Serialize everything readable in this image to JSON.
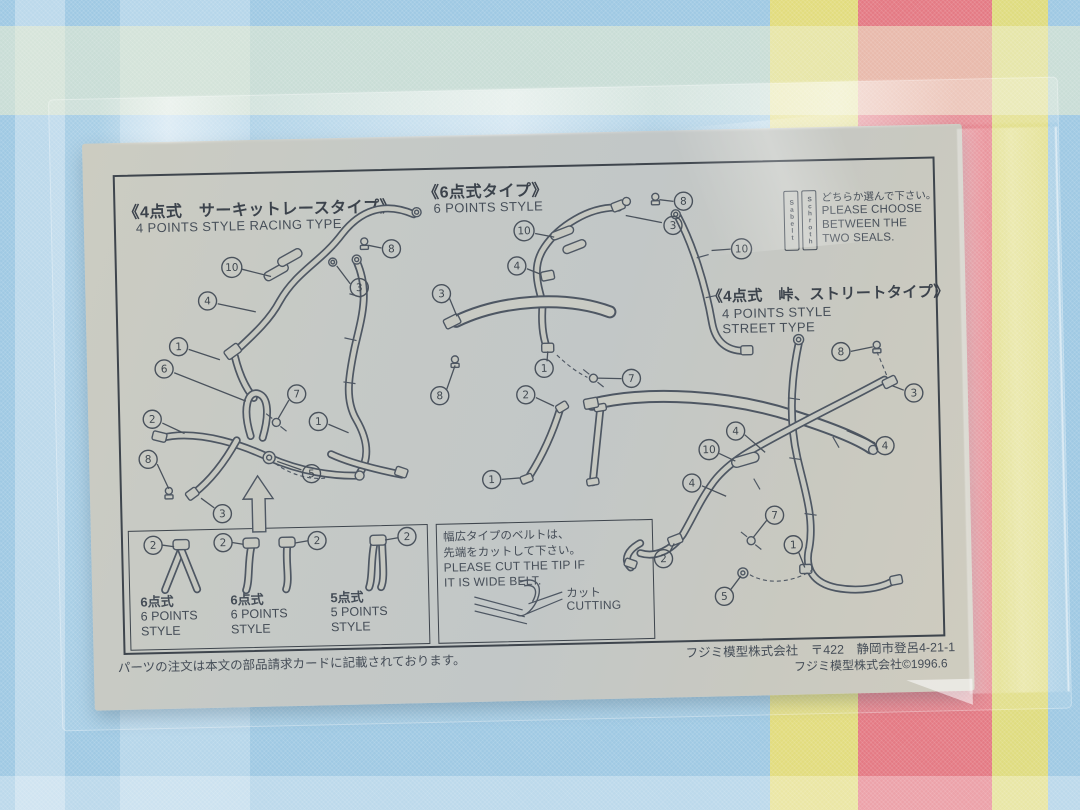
{
  "sheet": {
    "sections": {
      "racing": {
        "title_jp": "《4点式　サーキットレースタイプ》",
        "title_en": "4 POINTS STYLE RACING TYPE"
      },
      "six_point": {
        "title_jp": "《6点式タイプ》",
        "title_en": "6 POINTS STYLE"
      },
      "street": {
        "title_jp": "《4点式　峠、ストリートタイプ》",
        "title_en_1": "4 POINTS STYLE",
        "title_en_2": "STREET TYPE"
      },
      "seals": {
        "jp": "どちらか選んで下さい。",
        "en_1": "PLEASE CHOOSE",
        "en_2": "BETWEEN THE",
        "en_3": "TWO SEALS.",
        "seal_1": "Sabelt",
        "seal_2": "Schroth"
      }
    },
    "boxes": {
      "belt_box": {
        "items": [
          {
            "jp": "6点式",
            "en1": "6 POINTS",
            "en2": "STYLE"
          },
          {
            "jp": "6点式",
            "en1": "6 POINTS",
            "en2": "STYLE"
          },
          {
            "jp": "5点式",
            "en1": "5 POINTS",
            "en2": "STYLE"
          }
        ]
      },
      "cut_box": {
        "jp1": "幅広タイプのベルトは、",
        "jp2": "先端をカットして下さい。",
        "en1": "PLEASE CUT THE TIP IF",
        "en2": "IT IS WIDE BELT.",
        "cut_jp": "カット",
        "cut_en": "CUTTING"
      }
    },
    "callouts": {
      "racing": [
        "8",
        "3",
        "10",
        "4",
        "1",
        "6",
        "7",
        "2",
        "8",
        "3",
        "5",
        "1"
      ],
      "six_point": [
        "8",
        "3",
        "10",
        "4",
        "3",
        "8",
        "1",
        "7",
        "2",
        "1",
        "10"
      ],
      "street": [
        "8",
        "3",
        "4",
        "4",
        "10",
        "4",
        "7",
        "2",
        "1",
        "5"
      ],
      "belt_box": [
        "2",
        "2",
        "2",
        "2"
      ]
    },
    "footer": {
      "left": "パーツの注文は本文の部品請求カードに記載されております。",
      "right1": "フジミ模型株式会社　〒422　静岡市登呂4-21-1",
      "right2": "フジミ模型株式会社©1996.6"
    },
    "colors": {
      "paper": "#c6c8c1",
      "ink": "#454d57",
      "cloth_blue": "#9fc9e3",
      "cloth_red": "#e47a84",
      "cloth_yellow": "#e2dc7e"
    }
  }
}
